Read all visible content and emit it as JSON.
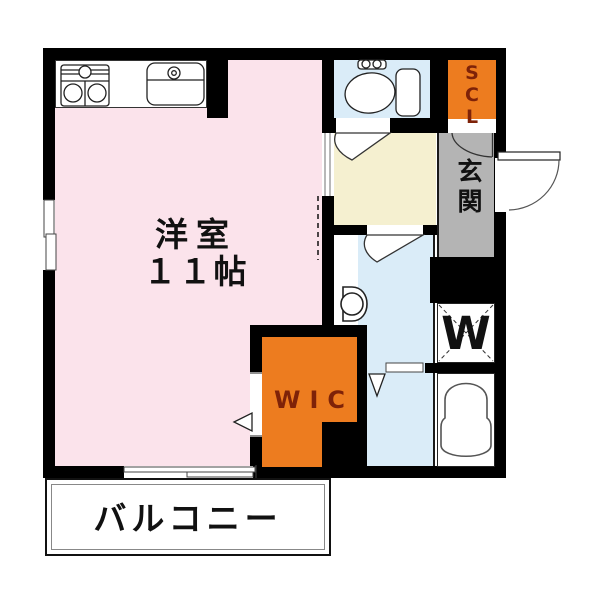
{
  "plan": {
    "title": "one-room apartment floor plan",
    "labels": {
      "main_room_name": "洋室",
      "main_room_size": "１１帖",
      "balcony": "バルコニー",
      "entrance": "玄関",
      "shoe_closet": "SCL",
      "walk_in_closet": "WIC",
      "washer": "W"
    },
    "rooms": [
      {
        "name": "western-room",
        "label": "洋室 １１帖",
        "color": "#FBE3EB"
      },
      {
        "name": "kitchen-counter",
        "label": "",
        "color": "#FFFFFF"
      },
      {
        "name": "toilet-room",
        "label": "",
        "color": "#DAECF8"
      },
      {
        "name": "shoe-closet",
        "label": "SCL",
        "color": "#ED7C1F"
      },
      {
        "name": "entrance-hall",
        "label": "玄関",
        "color": "#B4B4B4"
      },
      {
        "name": "hallway",
        "label": "",
        "color": "#F5F0D0"
      },
      {
        "name": "washroom",
        "label": "",
        "color": "#DAECF8"
      },
      {
        "name": "washer-space",
        "label": "W",
        "color": "#FFFFFF"
      },
      {
        "name": "bathroom",
        "label": "",
        "color": "#FFFFFF"
      },
      {
        "name": "walk-in-closet",
        "label": "WIC",
        "color": "#ED7C1F"
      },
      {
        "name": "balcony",
        "label": "バルコニー",
        "color": "#FFFFFF"
      }
    ],
    "colors": {
      "wall": "#000000",
      "main_room": "#FBE3EB",
      "wet_area": "#DAECF8",
      "hallway": "#F5F0D0",
      "closet_accent": "#ED7C1F",
      "entrance_gray": "#B4B4B4",
      "closet_text": "#7E2208",
      "text": "#111111"
    }
  }
}
